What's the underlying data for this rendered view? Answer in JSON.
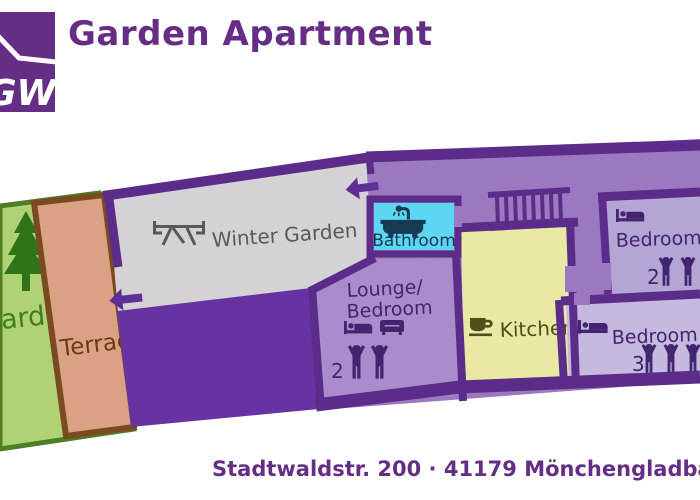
{
  "header": {
    "logo_text": "GW",
    "title": "Garden Apartment"
  },
  "footer": {
    "address": "Stadtwaldstr. 200 · 41179 Mönchengladbach"
  },
  "rooms": {
    "garden": {
      "label": "Garden"
    },
    "terrace": {
      "label": "Terrace"
    },
    "winter_garden": {
      "label": "Winter Garden"
    },
    "bathroom": {
      "label": "Bathroom"
    },
    "lounge_bedroom": {
      "label_line1": "Lounge/",
      "label_line2": "Bedroom",
      "capacity": "2"
    },
    "kitchen": {
      "label": "Kitchen"
    },
    "bedroom_top": {
      "label": "Bedroom",
      "capacity": "2"
    },
    "bedroom_bottom": {
      "label": "Bedroom",
      "capacity": "3"
    }
  },
  "icons": {
    "tree": "fir-tree silhouette",
    "picnic_table": "picnic table side view",
    "bathtub": "bathtub with shower",
    "sofa": "sofa",
    "bed": "bed with pillow",
    "person": "person with raised arms (occupancy)",
    "coffee_cup": "coffee cup on saucer",
    "stairs": "staircase rungs",
    "arrow_left": "entrance direction arrow"
  },
  "colors": {
    "brand": "#662d86",
    "wall": "#5c2c8a",
    "area_purple": "#6733a3",
    "corridor": "#9b79c0",
    "lounge": "#a98ccb",
    "bedroom1": "#b3a6d3",
    "bedroom2": "#c5b9dd",
    "room_text": "#432470",
    "bathroom": "#5cd6f2",
    "bathroom_text": "#173b52",
    "kitchen": "#e9e9a3",
    "kitchen_text": "#50501a",
    "winter_garden": "#d4d2d5",
    "winter_garden_text": "#595959",
    "garden": "#b0d274",
    "garden_border": "#4c7f26",
    "garden_text": "#3f7d22",
    "tree": "#2f7419",
    "terrace": "#dba184",
    "terrace_border": "#7b4a20",
    "terrace_text": "#6b3a10",
    "arrow": "#5f2e96"
  }
}
